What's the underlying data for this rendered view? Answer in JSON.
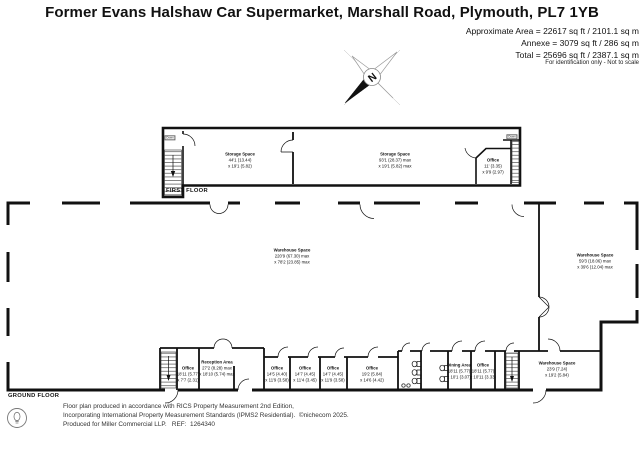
{
  "header": {
    "title": "Former Evans Halshaw Car Supermarket, Marshall Road, Plymouth, PL7 1YB",
    "approx_area": "Approximate Area = 22617 sq ft / 2101.1 sq m",
    "annexe": "Annexe = 3079 sq ft / 286 sq m",
    "total": "Total = 25696 sq ft / 2387.1 sq m",
    "disclaimer": "For identification only - Not to scale"
  },
  "compass": {
    "north_label": "N"
  },
  "first_floor": {
    "label": "FIRST FLOOR",
    "stair_label": "Down",
    "rooms": {
      "storage1": {
        "name": "Storage Space",
        "d1": "44'1 (13.44)",
        "d2": "x 19'1 (5.82)"
      },
      "storage2": {
        "name": "Storage Space",
        "d1": "93'1 (28.37) max",
        "d2": "x 19'1 (5.82) max"
      },
      "office": {
        "name": "Office",
        "d1": "11' (3.35)",
        "d2": "x 9'9 (2.97)"
      }
    }
  },
  "ground_floor": {
    "label": "GROUND FLOOR",
    "rooms": {
      "warehouse_main": {
        "name": "Warehouse Space",
        "d1": "220'9 (67.30) max",
        "d2": "x 78'2 (23.85) max"
      },
      "warehouse_right": {
        "name": "Warehouse Space",
        "d1": "59'3 (18.06) max",
        "d2": "x 39'6 (12.04) max"
      },
      "warehouse_small": {
        "name": "Warehouse Space",
        "d1": "23'9 (7.24)",
        "d2": "x 19'2 (5.84)"
      },
      "office_small": {
        "name": "Office",
        "d1": "18'11 (5.77)",
        "d2": "x 7'7 (2.31)"
      },
      "reception": {
        "name": "Reception Area",
        "d1": "27'2 (8.28) max",
        "d2": "x 18'10 (5.74) max"
      },
      "office_a": {
        "name": "Office",
        "d1": "14'5 (4.40)",
        "d2": "x 11'9 (3.58)"
      },
      "office_b": {
        "name": "Office",
        "d1": "14'7 (4.45)",
        "d2": "x 11'4 (3.45)"
      },
      "office_c": {
        "name": "Office",
        "d1": "14'7 (4.45)",
        "d2": "x 11'9 (3.58)"
      },
      "office_d": {
        "name": "Office",
        "d1": "19'2 (5.84)",
        "d2": "x 14'6 (4.42)"
      },
      "dining": {
        "name": "Dining Area",
        "d1": "18'11 (5.77)",
        "d2": "x 10'1 (3.07)"
      },
      "office_e": {
        "name": "Office",
        "d1": "18'11 (5.77)",
        "d2": "x 10'11 (3.33)"
      }
    }
  },
  "footer": {
    "line1": "Floor plan produced in accordance with RICS Property Measurement 2nd Edition,",
    "line2": "Incorporating International Property Measurement Standards (IPMS2 Residential).  ©nichecom 2025.",
    "line3": "Produced for Miller Commercial LLP.   REF:  1264340"
  }
}
